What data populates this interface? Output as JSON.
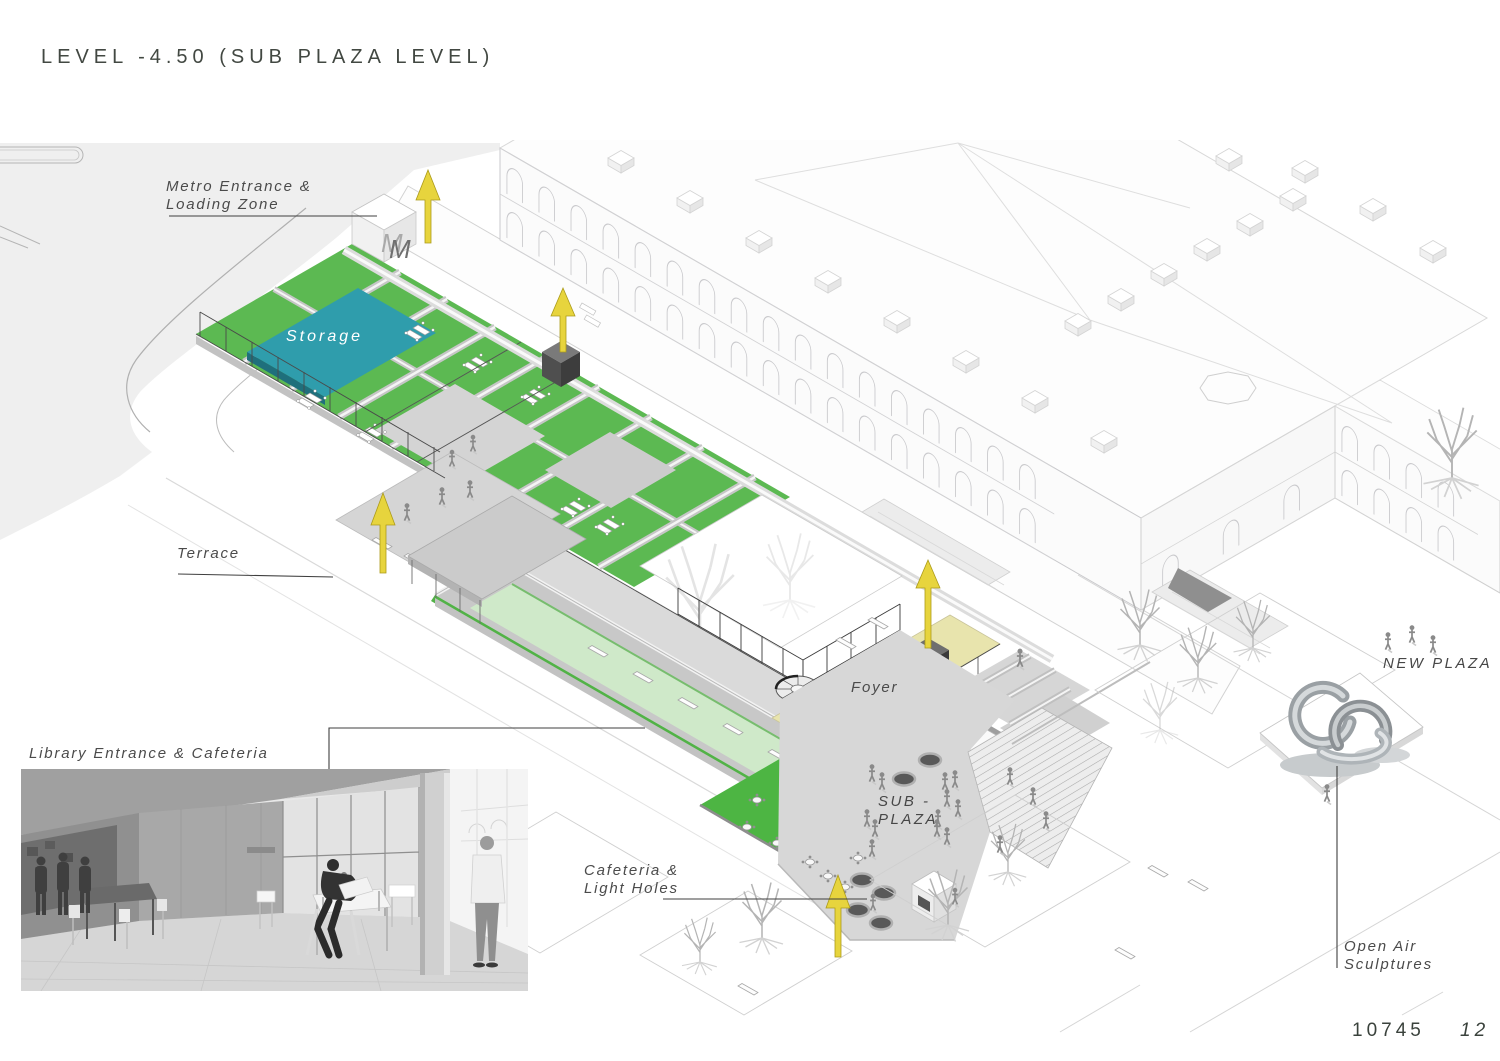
{
  "page": {
    "title": "LEVEL -4.50 (SUB PLAZA LEVEL)",
    "entry_code": "10745",
    "sheet_number": "12"
  },
  "labels": {
    "metro": {
      "line1": "Metro Entrance &",
      "line2": "Loading Zone"
    },
    "storage": "Storage",
    "terrace": "Terrace",
    "library": "Library Entrance & Cafeteria",
    "cafeteria": {
      "line1": "Cafeteria &",
      "line2": "Light Holes"
    },
    "foyer": "Foyer",
    "sub_plaza": {
      "line1": "SUB -",
      "line2": "PLAZA"
    },
    "new_plaza": "NEW PLAZA",
    "open_air": {
      "line1": "Open Air",
      "line2": "Sculptures"
    },
    "wall_sign": "MAT",
    "metro_logo": "M"
  },
  "colors": {
    "room_green": "#5cb952",
    "bright_green": "#4db543",
    "pool_green": "#cfe9c9",
    "storage_teal": "#2f9dac",
    "foyer_yellow": "#e8e4ad",
    "arrow_yellow": "#e7d43d",
    "label_ink": "#4b4b4b"
  }
}
